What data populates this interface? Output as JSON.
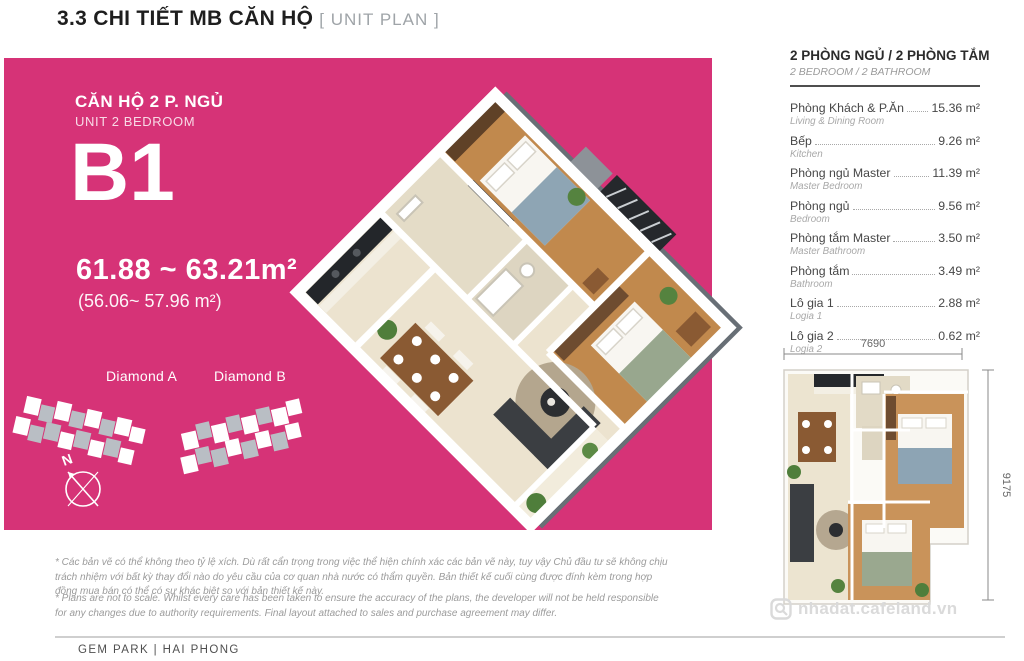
{
  "header": {
    "title": "3.3 CHI TIẾT MB CĂN HỘ",
    "subtitle": "[ UNIT PLAN ]"
  },
  "unit_panel": {
    "unit_title": "CĂN HỘ 2 P. NGỦ",
    "unit_subtitle": "UNIT 2 BEDROOM",
    "unit_code": "B1",
    "area_gross": "61.88 ~ 63.21m²",
    "area_net": "(56.06~ 57.96 m²)",
    "blocks": [
      {
        "label": "Diamond A"
      },
      {
        "label": "Diamond B"
      }
    ],
    "compass_label": "N"
  },
  "room_list": {
    "title": "2 PHÒNG NGỦ / 2 PHÒNG TẮM",
    "subtitle": "2 BEDROOM / 2 BATHROOM",
    "rooms": [
      {
        "name": "Phòng Khách & P.Ăn",
        "name_en": "Living & Dining Room",
        "area": "15.36 m²"
      },
      {
        "name": "Bếp",
        "name_en": "Kitchen",
        "area": "9.26 m²"
      },
      {
        "name": "Phòng ngủ Master",
        "name_en": "Master Bedroom",
        "area": "11.39 m²"
      },
      {
        "name": "Phòng ngủ",
        "name_en": "Bedroom",
        "area": "9.56 m²"
      },
      {
        "name": "Phòng tắm Master",
        "name_en": "Master Bathroom",
        "area": "3.50 m²"
      },
      {
        "name": "Phòng tắm",
        "name_en": "Bathroom",
        "area": "3.49 m²"
      },
      {
        "name": "Lô gia 1",
        "name_en": "Logia 1",
        "area": "2.88 m²"
      },
      {
        "name": "Lô gia 2",
        "name_en": "Logia 2",
        "area": "0.62 m²"
      }
    ]
  },
  "plan_2d": {
    "width_dim": "7690",
    "height_dim": "9175"
  },
  "watermark": "nhadat.cafeland.vn",
  "disclaimer": {
    "vi": "* Các bản vẽ có thể không theo tỷ lệ xích. Dù rất cẩn trọng trong việc thể hiện chính xác các bản vẽ này, tuy vậy Chủ đầu tư sẽ không chịu trách nhiệm với bất kỳ thay đổi nào do yêu cầu của cơ quan nhà nước có thẩm quyền. Bản thiết kế cuối cùng được đính kèm trong hợp đồng mua bán có thể có sự khác biệt so với bản thiết kế này.",
    "en": "* Plans are not to scale. Whilst every care has been taken to ensure the accuracy of the plans, the developer will not be held responsible for any changes due to authority requirements. Final layout attached to sales and purchase agreement may differ."
  },
  "footer": {
    "project": "GEM PARK | HAI PHONG"
  }
}
